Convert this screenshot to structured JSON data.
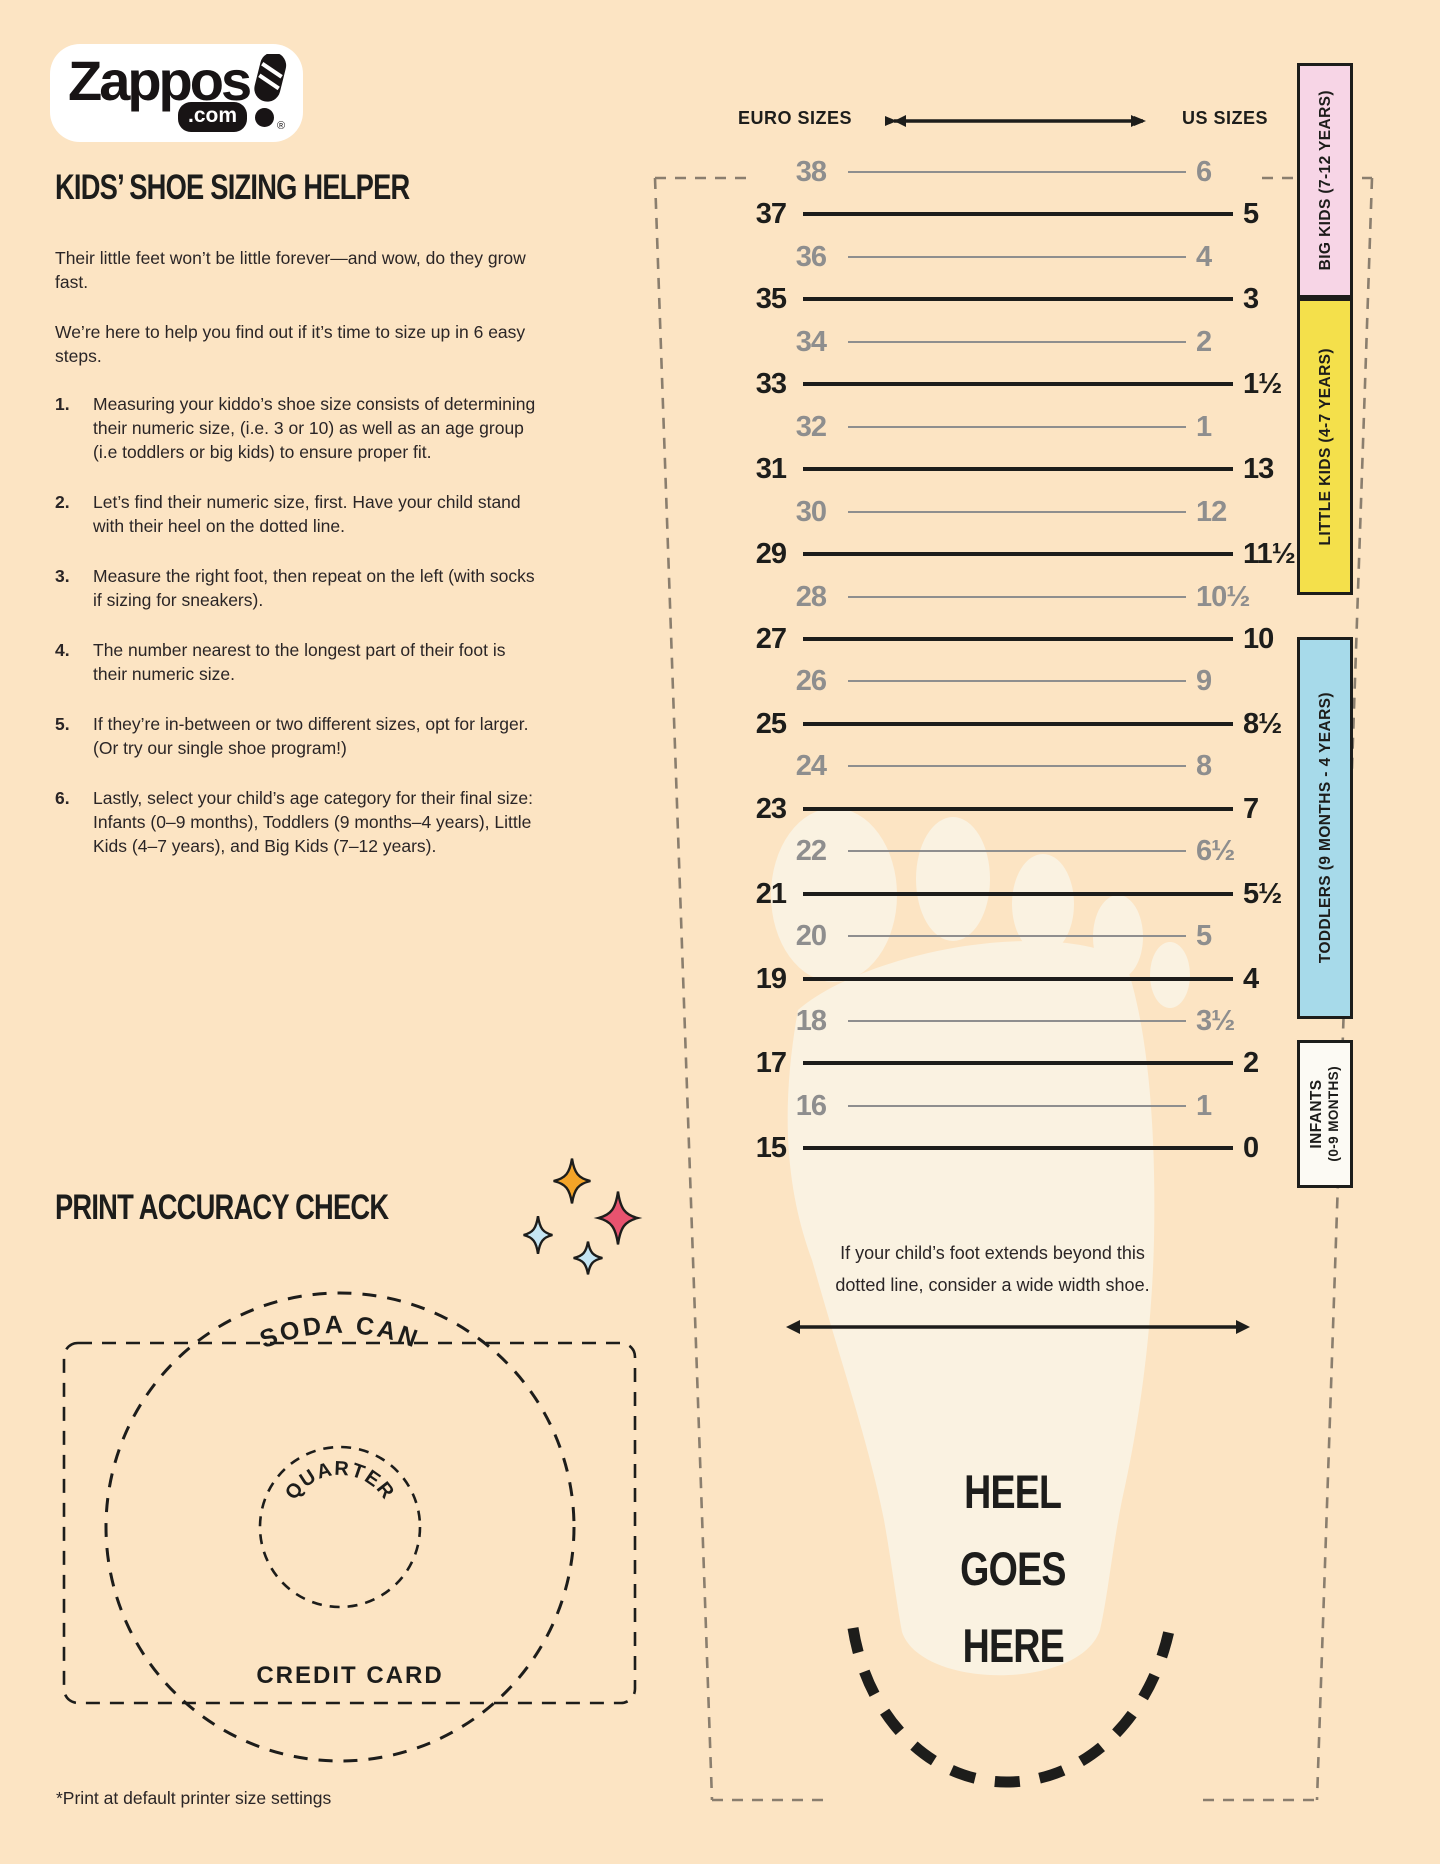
{
  "logo": {
    "word": "Zappos",
    "tld": ".com",
    "reg": "®"
  },
  "header": {
    "title": "KIDS’ SHOE SIZING HELPER",
    "intro1": "Their little feet won’t be little forever—and wow, do they grow fast.",
    "intro2": "We’re here to help you find out if it’s time to size up in 6 easy steps."
  },
  "steps": [
    {
      "num": "1.",
      "text": "Measuring your kiddo’s shoe size consists of determining their numeric size, (i.e. 3 or 10) as well as an age group (i.e toddlers or big kids) to ensure proper fit."
    },
    {
      "num": "2.",
      "text": "Let’s find their numeric size, first. Have your child stand with their heel on the dotted line."
    },
    {
      "num": "3.",
      "text": "Measure the right foot, then repeat on the left (with socks if sizing for sneakers)."
    },
    {
      "num": "4.",
      "text": "The number nearest to the longest part of their foot is their numeric size."
    },
    {
      "num": "5.",
      "text": "If they’re in-between or two different sizes, opt for larger. (Or try our single shoe program!)"
    },
    {
      "num": "6.",
      "text": "Lastly, select your child’s age category for their final size: Infants (0–9 months), Toddlers (9 months–4 years), Little Kids (4–7 years), and Big Kids (7–12 years)."
    }
  ],
  "print_check": {
    "title": "PRINT ACCURACY CHECK",
    "soda_can": "SODA CAN",
    "quarter": "QUARTER",
    "credit_card": "CREDIT CARD",
    "footnote": "*Print at default printer size settings"
  },
  "sizing": {
    "euro_label": "EURO SIZES",
    "us_label": "US SIZES",
    "rows": [
      {
        "euro": "38",
        "us": "6",
        "variant": "light"
      },
      {
        "euro": "37",
        "us": "5",
        "variant": "bold"
      },
      {
        "euro": "36",
        "us": "4",
        "variant": "light"
      },
      {
        "euro": "35",
        "us": "3",
        "variant": "bold"
      },
      {
        "euro": "34",
        "us": "2",
        "variant": "light"
      },
      {
        "euro": "33",
        "us": "1½",
        "variant": "bold"
      },
      {
        "euro": "32",
        "us": "1",
        "variant": "light"
      },
      {
        "euro": "31",
        "us": "13",
        "variant": "bold"
      },
      {
        "euro": "30",
        "us": "12",
        "variant": "light"
      },
      {
        "euro": "29",
        "us": "11½",
        "variant": "bold"
      },
      {
        "euro": "28",
        "us": "10½",
        "variant": "light"
      },
      {
        "euro": "27",
        "us": "10",
        "variant": "bold"
      },
      {
        "euro": "26",
        "us": "9",
        "variant": "light"
      },
      {
        "euro": "25",
        "us": "8½",
        "variant": "bold"
      },
      {
        "euro": "24",
        "us": "8",
        "variant": "light"
      },
      {
        "euro": "23",
        "us": "7",
        "variant": "bold"
      },
      {
        "euro": "22",
        "us": "6½",
        "variant": "light"
      },
      {
        "euro": "21",
        "us": "5½",
        "variant": "bold"
      },
      {
        "euro": "20",
        "us": "5",
        "variant": "light"
      },
      {
        "euro": "19",
        "us": "4",
        "variant": "bold"
      },
      {
        "euro": "18",
        "us": "3½",
        "variant": "light"
      },
      {
        "euro": "17",
        "us": "2",
        "variant": "bold"
      },
      {
        "euro": "16",
        "us": "1",
        "variant": "light"
      },
      {
        "euro": "15",
        "us": "0",
        "variant": "bold"
      }
    ],
    "bands": [
      {
        "label": "BIG KIDS (7-12 YEARS)",
        "color": "#F7D5E6"
      },
      {
        "label": "LITTLE KIDS (4-7 YEARS)",
        "color": "#F4E04B"
      },
      {
        "label": "TODDLERS (9 MONTHS - 4 YEARS)",
        "color": "#A7DAEA"
      },
      {
        "label": "INFANTS",
        "label2": "(0-9 MONTHS)",
        "color": "#FCFAF4"
      }
    ],
    "wide_note_line1": "If your child’s foot extends beyond this",
    "wide_note_line2": "dotted line, consider a wide width shoe.",
    "heel_lines": [
      "HEEL",
      "GOES",
      "HERE"
    ]
  },
  "colors": {
    "background": "#FCE4C3",
    "ink": "#1d1d1b",
    "gray": "#8E8E8E",
    "foot": "#FAF2E1",
    "sparkle_orange": "#F4A428",
    "sparkle_pink": "#E8536F",
    "sparkle_blue": "#C6E6F3"
  }
}
